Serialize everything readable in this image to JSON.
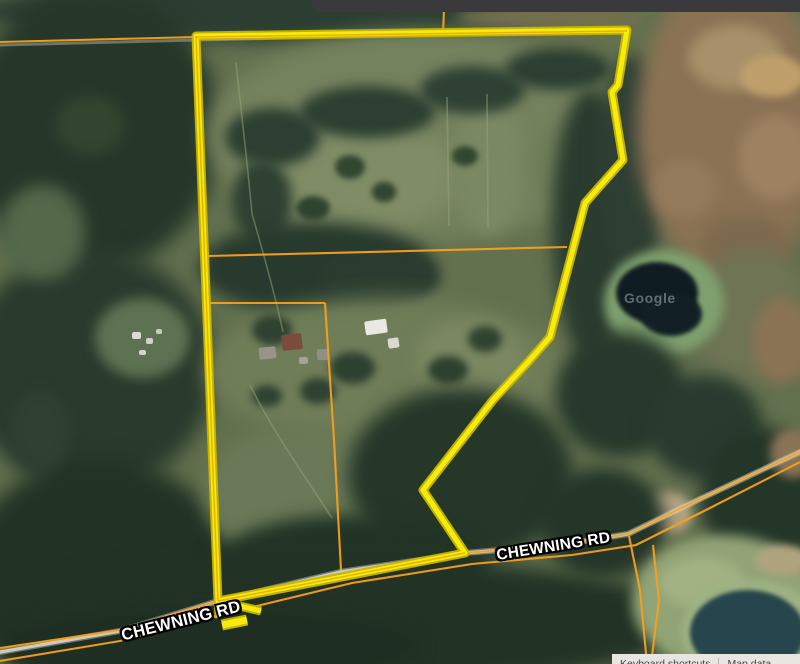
{
  "map": {
    "road_labels": [
      {
        "text": "CHEWNING RD"
      },
      {
        "text": "CHEWNING RD"
      }
    ],
    "watermark_text": "Google",
    "bottom_bar": {
      "items": [
        "Keyboard shortcuts",
        "Map data"
      ]
    }
  },
  "colors": {
    "boundary_yellow": "#f6ec0c",
    "boundary_edge": "#c9b500",
    "boundary_core_orange": "#e89c00",
    "parcel_orange": "#f7a01d",
    "road_label_fill": "#ffffff",
    "top_bar": "#3a3a3c",
    "bottom_bar_bg": "#e8e6e1",
    "bottom_bar_text": "#444746",
    "watermark_color": "rgba(215,225,225,0.4)"
  }
}
